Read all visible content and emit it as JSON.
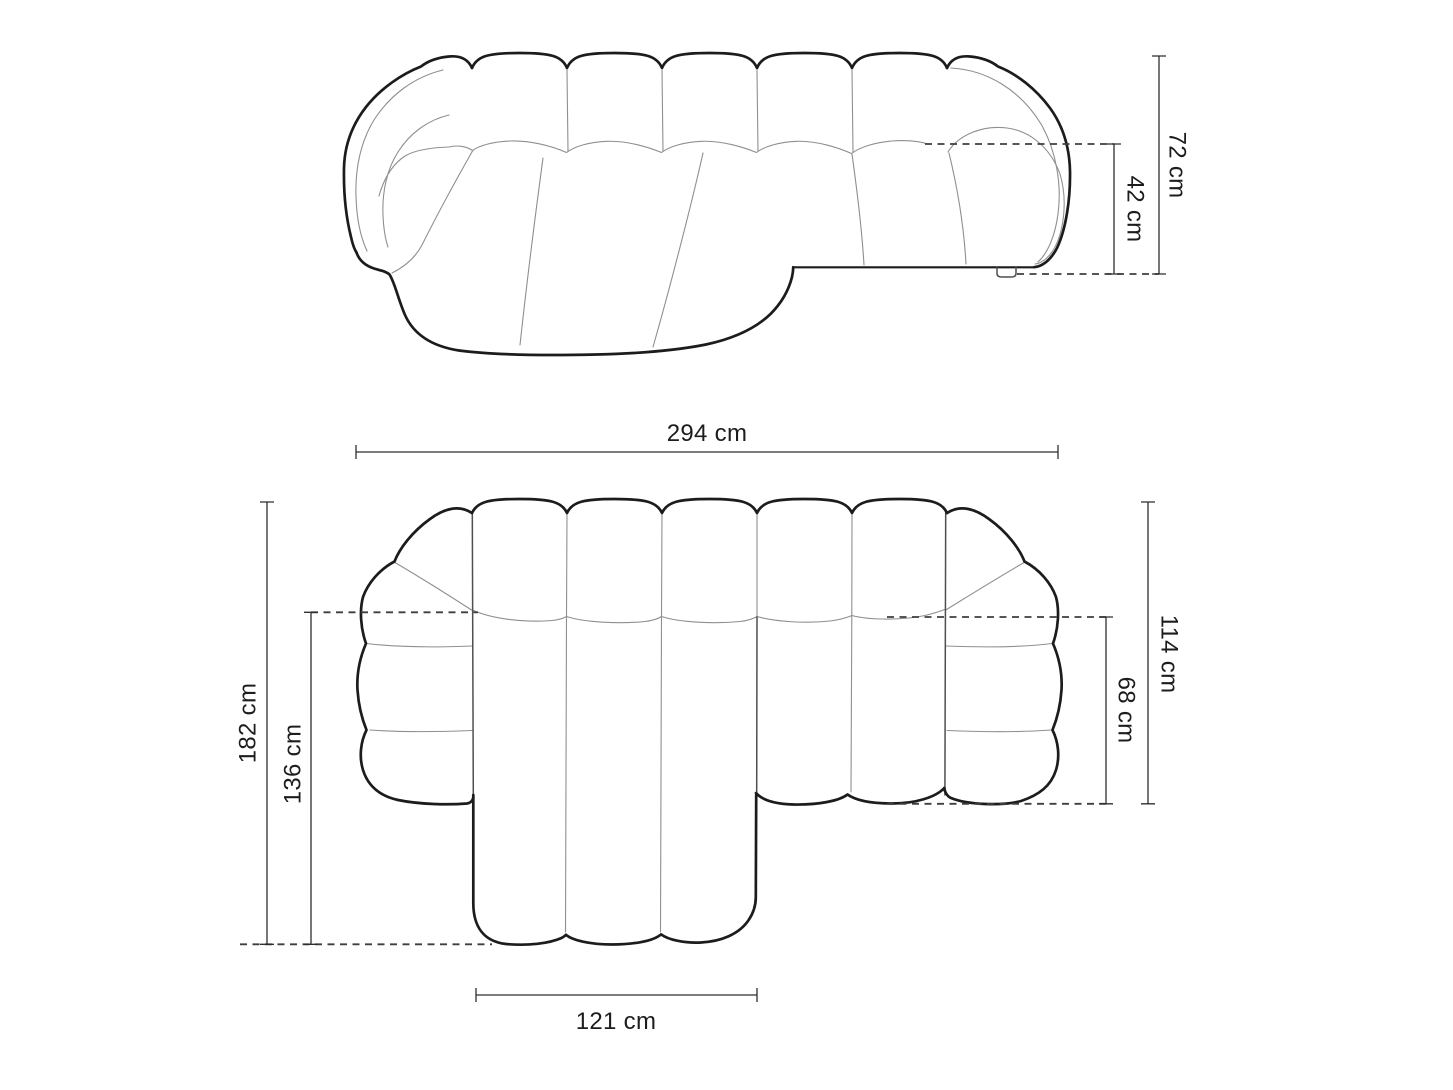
{
  "views": {
    "front": {
      "dimensions": {
        "total_height": "72 cm",
        "seat_height": "42 cm"
      }
    },
    "plan": {
      "dimensions": {
        "total_width": "294 cm",
        "total_depth": "182 cm",
        "chaise_depth": "136 cm",
        "chaise_width": "121 cm",
        "body_depth": "114 cm",
        "seat_depth": "68 cm"
      }
    }
  },
  "colors": {
    "background": "#ffffff",
    "outline": "#1c1c1c",
    "seam": "#8f8f8f",
    "boundary": "#4f4f4f",
    "dash": "#3f3f3f",
    "dimension": "#2e2e2e",
    "label": "#1d1d1d"
  }
}
